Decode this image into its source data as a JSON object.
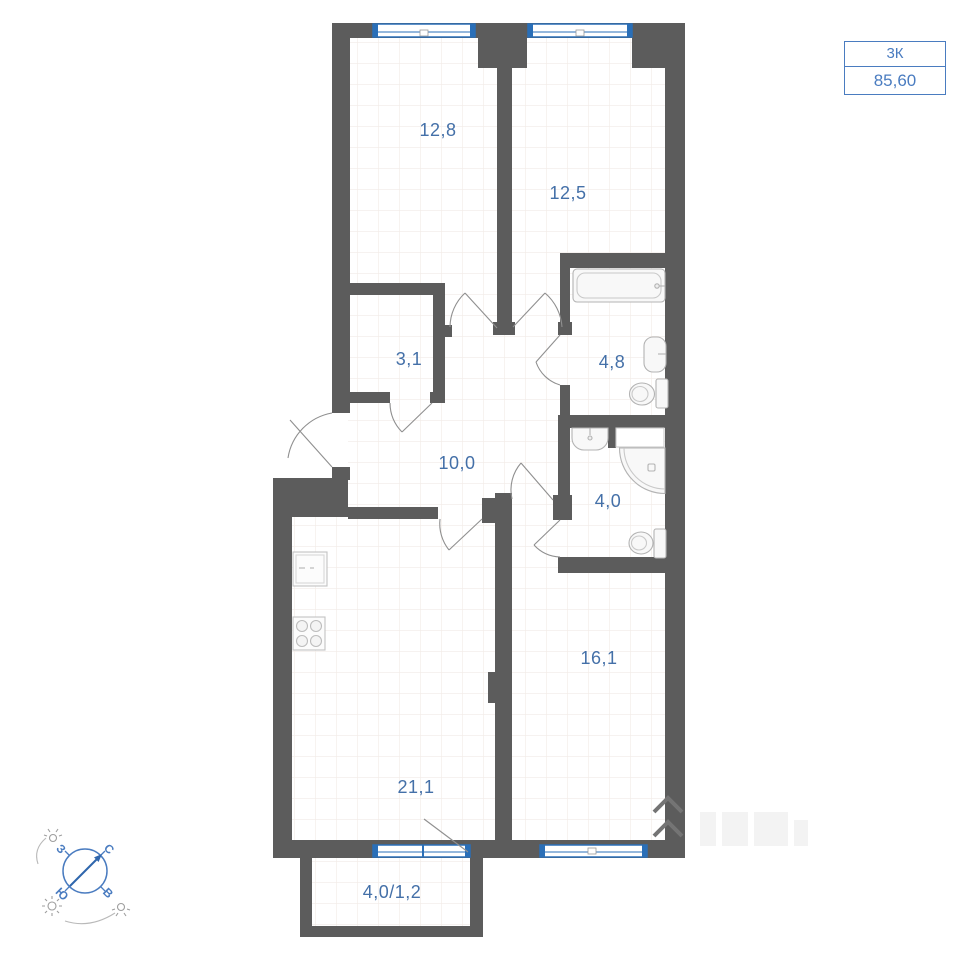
{
  "plan": {
    "badge": {
      "rooms_label": "3К",
      "area_label": "85,60"
    },
    "room_areas": [
      {
        "name": "bedroom-1",
        "area": "12,8"
      },
      {
        "name": "bedroom-2",
        "area": "12,5"
      },
      {
        "name": "wardrobe",
        "area": "3,1"
      },
      {
        "name": "bathroom",
        "area": "4,8"
      },
      {
        "name": "hallway",
        "area": "10,0"
      },
      {
        "name": "shower-room",
        "area": "4,0"
      },
      {
        "name": "room-3",
        "area": "16,1"
      },
      {
        "name": "kitchen-living",
        "area": "21,1"
      },
      {
        "name": "balcony",
        "area": "4,0/1,2"
      }
    ],
    "compass": {
      "north": "С",
      "east": "В",
      "south": "Ю",
      "west": "З"
    },
    "colors": {
      "wall": "#5c5c5c",
      "window_blue": "#2a6fb8",
      "label_blue": "#4470a8",
      "badge_blue": "#4a7cc0",
      "fixture_stroke": "#b3b3b3"
    }
  }
}
